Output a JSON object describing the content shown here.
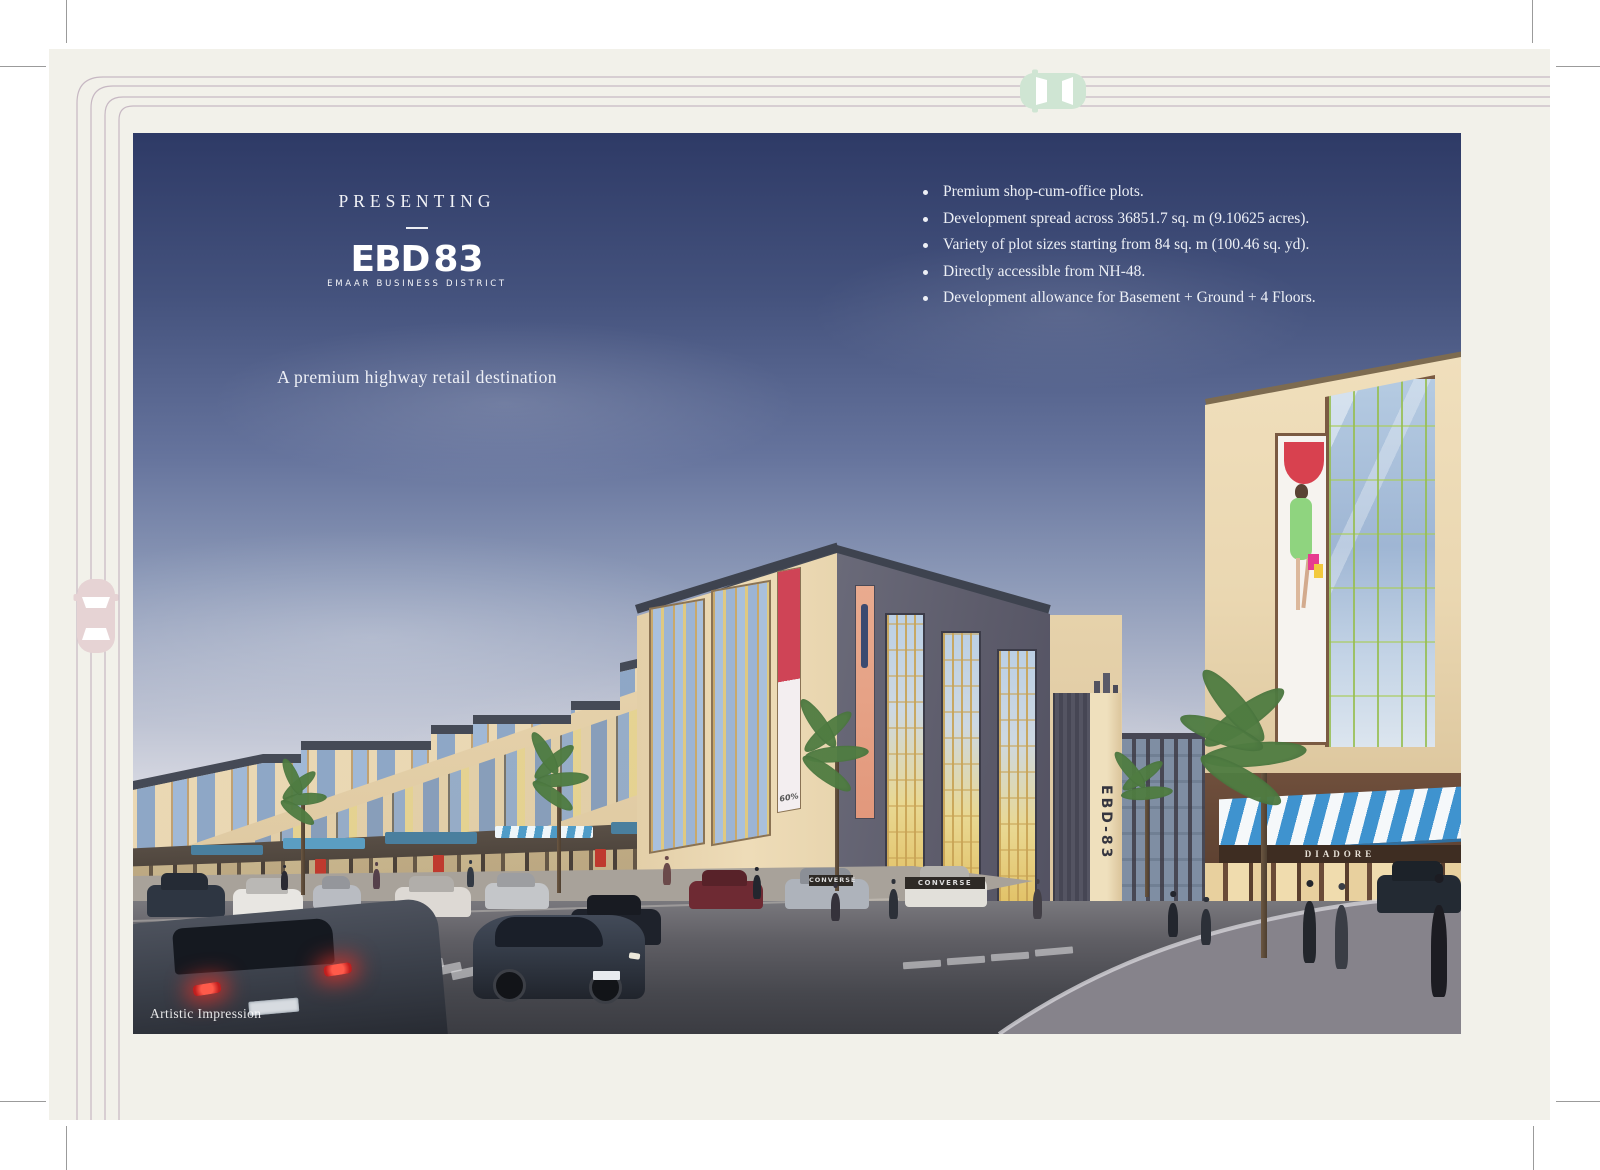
{
  "page": {
    "background": "#ffffff",
    "sheet_color": "#f2f1ea",
    "road_line_color": "#b9a6b6",
    "crop_mark_color": "#9b9b9b"
  },
  "decor": {
    "top_car_icon": "car-top-view-mint",
    "left_car_icon": "car-top-view-pink",
    "top_car_color": "#cfe5d3",
    "left_car_color": "#e6d3d4"
  },
  "hero": {
    "presenting": "PRESENTING",
    "logo": {
      "ebd": "EBD",
      "num": "83",
      "subtitle": "EMAAR BUSINESS DISTRICT"
    },
    "tagline": "A premium highway retail destination"
  },
  "bullets": [
    "Premium shop-cum-office plots.",
    "Development spread across 36851.7 sq. m (9.10625 acres).",
    "Variety of plot sizes starting from 84 sq. m (100.46 sq. yd).",
    "Directly accessible from NH-48.",
    "Development allowance for Basement + Ground + 4 Floors."
  ],
  "image": {
    "caption": "Artistic Impression",
    "signage": {
      "pylon": "EBD-83",
      "store_left": "CONVERSE",
      "store_corner": "CONVERSE",
      "store_right": "DIADORE",
      "sale_banner": "60%"
    },
    "colors": {
      "sky_top": "#2e3a66",
      "sky_horizon": "#ece7e0",
      "building_cream": "#ecd9b5",
      "building_gray": "#5d5c6b",
      "glass_blue": "#9db7d8",
      "glass_gold": "#c9a86a",
      "awning_blue": "#3f93cf",
      "road": "#46474d",
      "billboard_red": "#d8414f",
      "billboard_green": "#8fd47f"
    }
  }
}
